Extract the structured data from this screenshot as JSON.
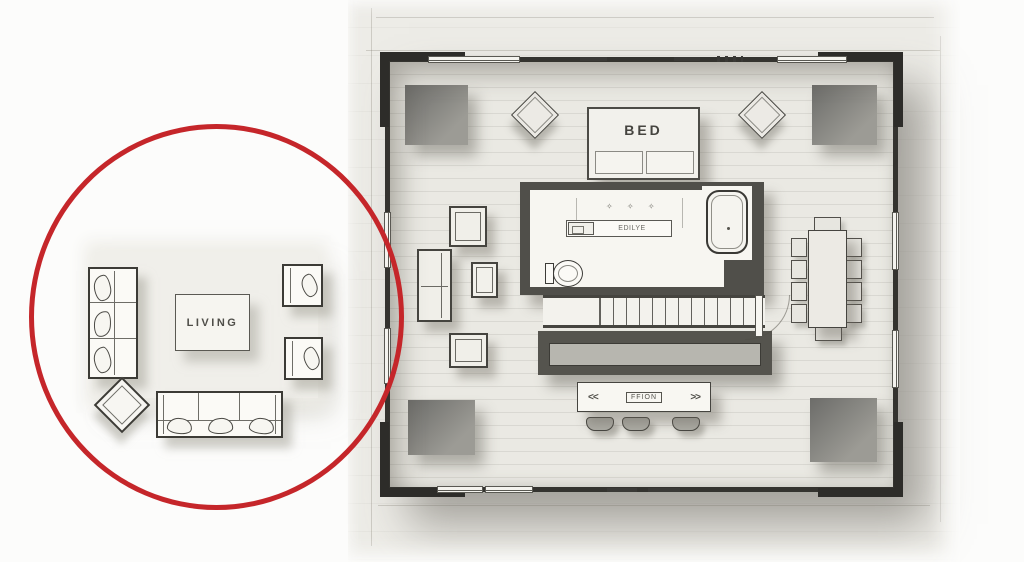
{
  "scene": {
    "type": "floor-plan-sketch",
    "background": "#fcfcfb",
    "paper_color": "#edece7",
    "wall_color": "#34332f"
  },
  "highlight": {
    "shape": "circle",
    "circle_color": "#c5262a",
    "focus": "living-room-furniture-arrangement"
  },
  "living_group": {
    "label": "LIVING",
    "left_sofa_cushions": 3,
    "bottom_sofa_cushions": 3,
    "armchairs": 2,
    "diamond_side_table": 1
  },
  "plan": {
    "bed": {
      "label": "BED",
      "pillows": 2
    },
    "bathroom": {
      "vanity_label": "EDILYE",
      "sparkles": "✧ ✧ ✧",
      "fixtures": [
        "sink",
        "toilet",
        "bathtub"
      ]
    },
    "island": {
      "left_arrow": "<<",
      "label": "FFION",
      "right_arrow": ">>",
      "stools": 3
    },
    "dining": {
      "chairs": 10
    },
    "corner_rugs": 4,
    "diamond_stools": 2
  }
}
